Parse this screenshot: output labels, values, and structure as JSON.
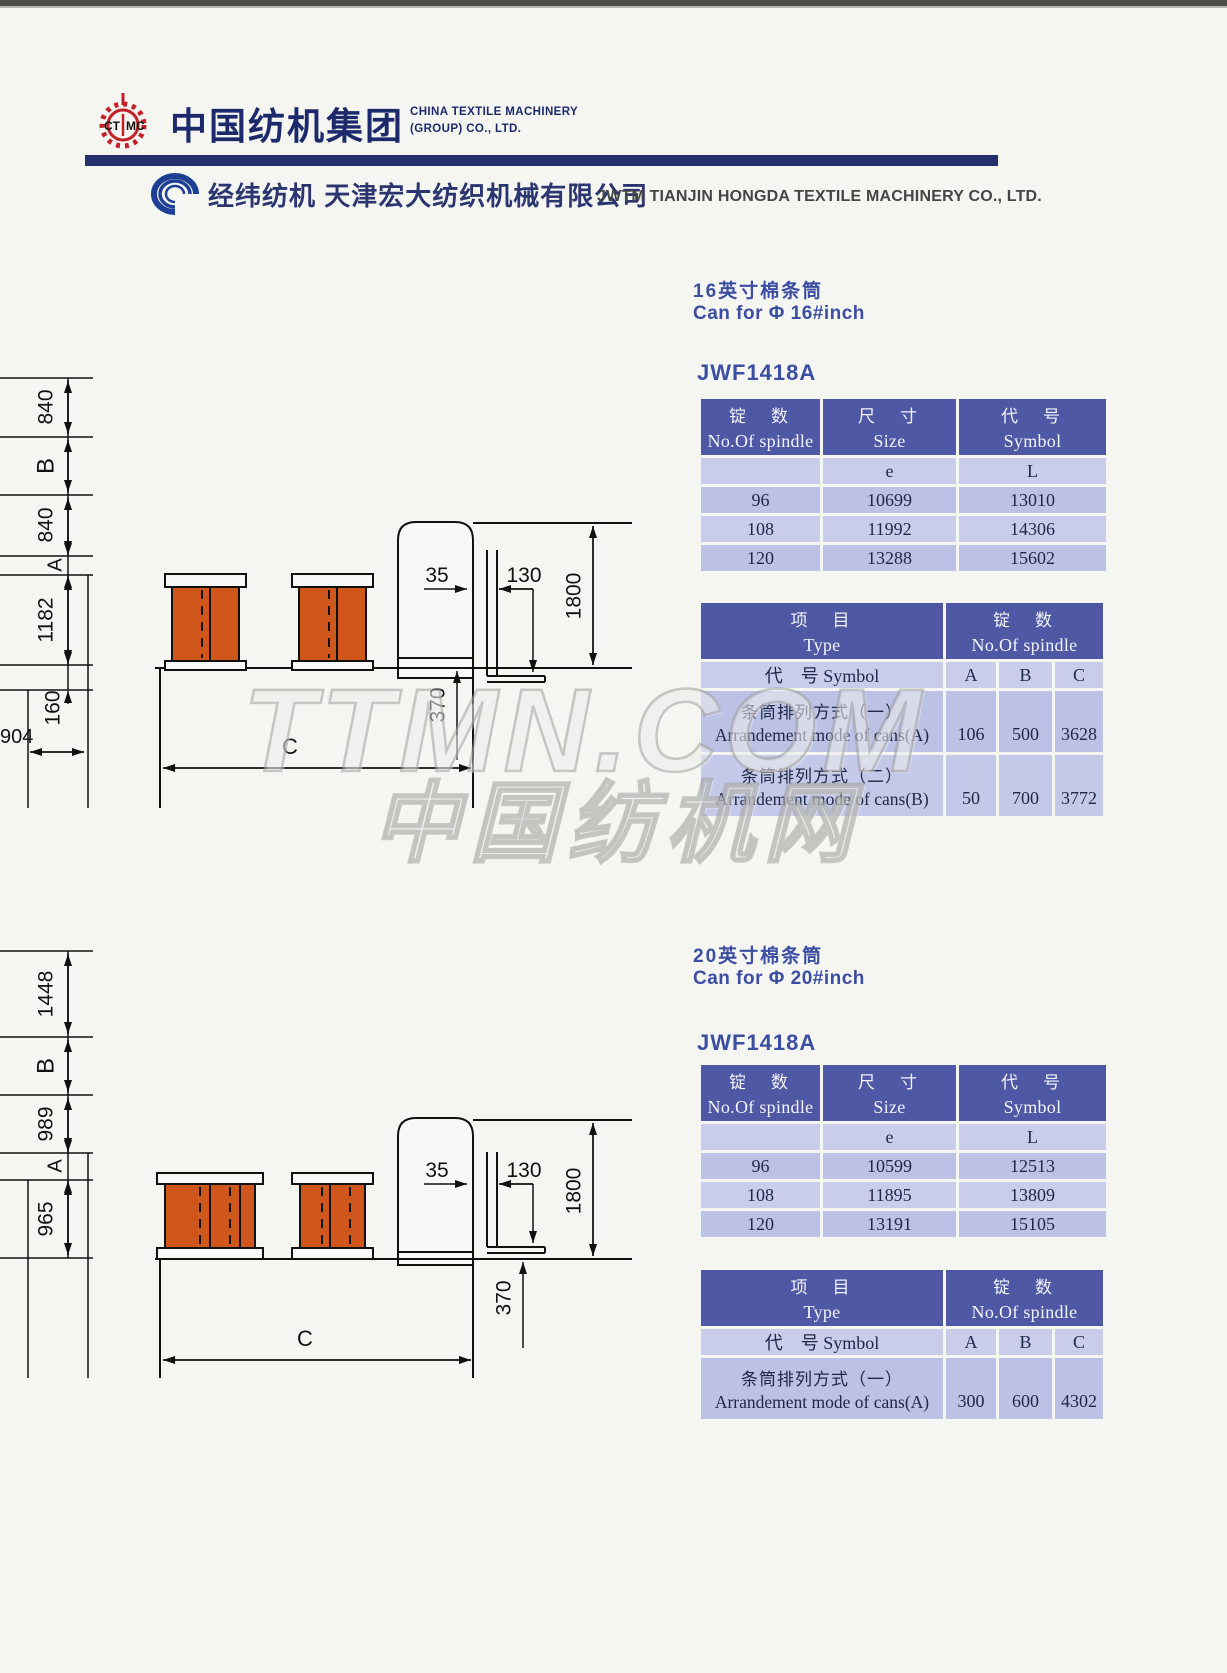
{
  "header": {
    "ctmc_logo": "CTMC",
    "ctmc_cn": "中国纺机集团",
    "ctmc_en1": "CHINA TEXTILE MACHINERY",
    "ctmc_en2": "(GROUP) CO., LTD.",
    "jwtm_cn": "经纬纺机  天津宏大纺织机械有限公司",
    "jwtm_en": "JWTM TIANJIN HONGDA  TEXTILE MACHINERY CO.,  LTD."
  },
  "watermark": {
    "line1": "TTMN.COM",
    "line2": "中国纺机网"
  },
  "colors": {
    "navy_bar": "#272e6d",
    "table_header": "#4f58a4",
    "row_light": "#c9cdeb",
    "row_dark": "#bcc2e5",
    "title_blue": "#3b4ea2",
    "can_orange": "#d0571c",
    "logo_red": "#c32027"
  },
  "sections": [
    {
      "title_cn": "16英寸棉条筒",
      "title_en": "Can for Φ 16#inch",
      "model": "JWF1418A",
      "spec_table": {
        "cols": [
          {
            "cn": "锭　数",
            "en": "No.Of spindle"
          },
          {
            "cn": "尺　寸",
            "en": "Size"
          },
          {
            "cn": "代　号",
            "en": "Symbol"
          }
        ],
        "sub": [
          "",
          "e",
          "L"
        ],
        "rows": [
          [
            "96",
            "10699",
            "13010"
          ],
          [
            "108",
            "11992",
            "14306"
          ],
          [
            "120",
            "13288",
            "15602"
          ]
        ]
      },
      "arr_table": {
        "left_cn": "项　目",
        "left_en": "Type",
        "right_cn": "锭　数",
        "right_en": "No.Of spindle",
        "symbol_label": "代　号 Symbol",
        "col_a": "A",
        "col_b": "B",
        "col_c": "C",
        "rows": [
          {
            "cn": "条筒排列方式（一）",
            "en": "Arrandement mode of cans(A)",
            "a": "106",
            "b": "500",
            "c": "3628"
          },
          {
            "cn": "条筒排列方式（二）",
            "en": "Arrandement mode of cans(B)",
            "a": "50",
            "b": "700",
            "c": "3772"
          }
        ]
      },
      "drawing": {
        "v_dims": [
          "840",
          "B",
          "840",
          "A",
          "1182",
          "160"
        ],
        "dim_904": "904",
        "dim_35": "35",
        "dim_130": "130",
        "dim_1800": "1800",
        "dim_370": "370",
        "dim_c": "C"
      }
    },
    {
      "title_cn": "20英寸棉条筒",
      "title_en": "Can for Φ 20#inch",
      "model": "JWF1418A",
      "spec_table": {
        "cols": [
          {
            "cn": "锭　数",
            "en": "No.Of spindle"
          },
          {
            "cn": "尺　寸",
            "en": "Size"
          },
          {
            "cn": "代　号",
            "en": "Symbol"
          }
        ],
        "sub": [
          "",
          "e",
          "L"
        ],
        "rows": [
          [
            "96",
            "10599",
            "12513"
          ],
          [
            "108",
            "11895",
            "13809"
          ],
          [
            "120",
            "13191",
            "15105"
          ]
        ]
      },
      "arr_table": {
        "left_cn": "项　目",
        "left_en": "Type",
        "right_cn": "锭　数",
        "right_en": "No.Of spindle",
        "symbol_label": "代　号 Symbol",
        "col_a": "A",
        "col_b": "B",
        "col_c": "C",
        "rows": [
          {
            "cn": "条筒排列方式（一）",
            "en": "Arrandement mode of cans(A)",
            "a": "300",
            "b": "600",
            "c": "4302"
          }
        ]
      },
      "drawing": {
        "v_dims": [
          "1448",
          "B",
          "989",
          "A",
          "965"
        ],
        "dim_35": "35",
        "dim_130": "130",
        "dim_1800": "1800",
        "dim_370": "370",
        "dim_c": "C"
      }
    }
  ]
}
